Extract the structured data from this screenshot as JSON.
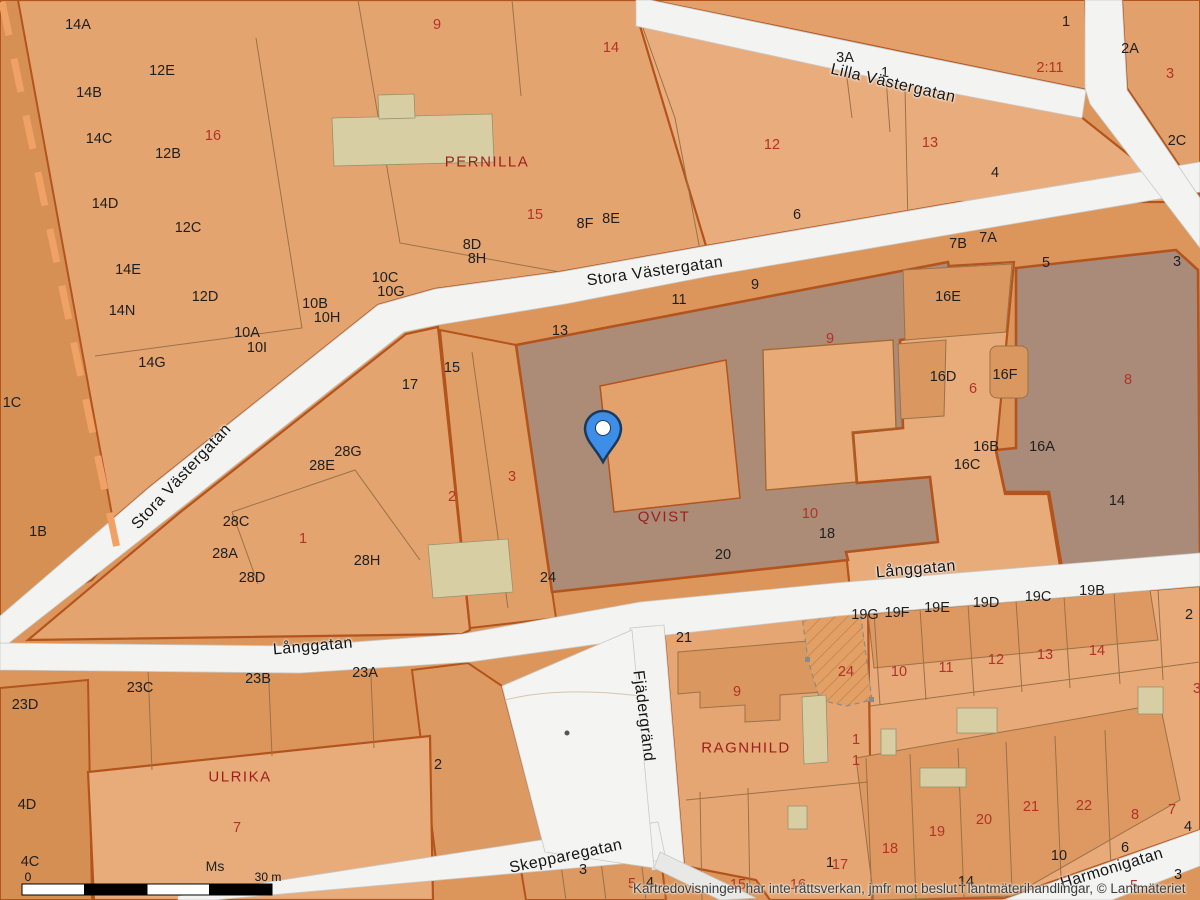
{
  "map": {
    "attribution": "Kartredovisningen har inte rättsverkan, jmfr mot beslut i lantmäterihandlingar, © Lantmäteriet",
    "scale_bar": {
      "start": "0",
      "end": "30 m",
      "sheet": "Ms"
    },
    "pin": {
      "x": 603,
      "y": 462
    },
    "streets": [
      {
        "name": "Stora Västergatan",
        "x": 182,
        "y": 477,
        "rot": -47
      },
      {
        "name": "Stora Västergatan",
        "x": 655,
        "y": 272,
        "rot": -8
      },
      {
        "name": "Lilla Västergatan",
        "x": 893,
        "y": 84,
        "rot": 13
      },
      {
        "name": "Långgatan",
        "x": 916,
        "y": 570,
        "rot": -5
      },
      {
        "name": "Långgatan",
        "x": 313,
        "y": 647,
        "rot": -5
      },
      {
        "name": "Fjädergränd",
        "x": 643,
        "y": 716,
        "rot": 83
      },
      {
        "name": "Skepparegatan",
        "x": 566,
        "y": 857,
        "rot": -12
      },
      {
        "name": "Harmonigatan",
        "x": 1112,
        "y": 869,
        "rot": -17
      }
    ],
    "blocks": [
      {
        "name": "PERNILLA",
        "x": 487,
        "y": 162
      },
      {
        "name": "QVIST",
        "x": 664,
        "y": 517
      },
      {
        "name": "ULRIKA",
        "x": 240,
        "y": 777
      },
      {
        "name": "RAGNHILD",
        "x": 746,
        "y": 748
      }
    ],
    "lot_numbers": [
      {
        "t": "9",
        "x": 437,
        "y": 25
      },
      {
        "t": "14",
        "x": 611,
        "y": 48
      },
      {
        "t": "16",
        "x": 213,
        "y": 136
      },
      {
        "t": "12",
        "x": 772,
        "y": 145
      },
      {
        "t": "13",
        "x": 930,
        "y": 143
      },
      {
        "t": "2:11",
        "x": 1050,
        "y": 68
      },
      {
        "t": "3",
        "x": 1170,
        "y": 74
      },
      {
        "t": "15",
        "x": 535,
        "y": 215
      },
      {
        "t": "9",
        "x": 830,
        "y": 339
      },
      {
        "t": "6",
        "x": 973,
        "y": 389
      },
      {
        "t": "8",
        "x": 1128,
        "y": 380
      },
      {
        "t": "1",
        "x": 303,
        "y": 539
      },
      {
        "t": "2",
        "x": 452,
        "y": 497
      },
      {
        "t": "3",
        "x": 512,
        "y": 477
      },
      {
        "t": "10",
        "x": 810,
        "y": 514
      },
      {
        "t": "24",
        "x": 846,
        "y": 672
      },
      {
        "t": "9",
        "x": 737,
        "y": 692
      },
      {
        "t": "7",
        "x": 237,
        "y": 828
      },
      {
        "t": "1",
        "x": 856,
        "y": 740
      },
      {
        "t": "1",
        "x": 856,
        "y": 761
      },
      {
        "t": "10",
        "x": 899,
        "y": 672
      },
      {
        "t": "11",
        "x": 946,
        "y": 668
      },
      {
        "t": "12",
        "x": 996,
        "y": 660
      },
      {
        "t": "13",
        "x": 1045,
        "y": 655
      },
      {
        "t": "14",
        "x": 1097,
        "y": 651
      },
      {
        "t": "3",
        "x": 1197,
        "y": 689
      },
      {
        "t": "18",
        "x": 890,
        "y": 849
      },
      {
        "t": "19",
        "x": 937,
        "y": 832
      },
      {
        "t": "20",
        "x": 984,
        "y": 820
      },
      {
        "t": "21",
        "x": 1031,
        "y": 807
      },
      {
        "t": "22",
        "x": 1084,
        "y": 806
      },
      {
        "t": "8",
        "x": 1135,
        "y": 815
      },
      {
        "t": "7",
        "x": 1172,
        "y": 810
      },
      {
        "t": "15",
        "x": 738,
        "y": 885
      },
      {
        "t": "16",
        "x": 798,
        "y": 885
      },
      {
        "t": "17",
        "x": 840,
        "y": 865
      },
      {
        "t": "5",
        "x": 632,
        "y": 884
      },
      {
        "t": "5",
        "x": 1134,
        "y": 886
      }
    ],
    "addresses": [
      {
        "t": "14A",
        "x": 78,
        "y": 25
      },
      {
        "t": "12E",
        "x": 162,
        "y": 71
      },
      {
        "t": "14B",
        "x": 89,
        "y": 93
      },
      {
        "t": "14C",
        "x": 99,
        "y": 139
      },
      {
        "t": "12B",
        "x": 168,
        "y": 154
      },
      {
        "t": "14D",
        "x": 105,
        "y": 204
      },
      {
        "t": "12C",
        "x": 188,
        "y": 228
      },
      {
        "t": "14E",
        "x": 128,
        "y": 270
      },
      {
        "t": "12D",
        "x": 205,
        "y": 297
      },
      {
        "t": "14N",
        "x": 122,
        "y": 311
      },
      {
        "t": "10C",
        "x": 385,
        "y": 278
      },
      {
        "t": "10G",
        "x": 391,
        "y": 292
      },
      {
        "t": "10B",
        "x": 315,
        "y": 304
      },
      {
        "t": "10H",
        "x": 327,
        "y": 318
      },
      {
        "t": "10A",
        "x": 247,
        "y": 333
      },
      {
        "t": "10I",
        "x": 257,
        "y": 348
      },
      {
        "t": "14G",
        "x": 152,
        "y": 363
      },
      {
        "t": "1C",
        "x": 12,
        "y": 403
      },
      {
        "t": "1B",
        "x": 38,
        "y": 532
      },
      {
        "t": "8F",
        "x": 585,
        "y": 224
      },
      {
        "t": "8E",
        "x": 611,
        "y": 219
      },
      {
        "t": "8D",
        "x": 472,
        "y": 245
      },
      {
        "t": "8H",
        "x": 477,
        "y": 259
      },
      {
        "t": "3A",
        "x": 845,
        "y": 58
      },
      {
        "t": "1",
        "x": 885,
        "y": 73
      },
      {
        "t": "1",
        "x": 1066,
        "y": 22
      },
      {
        "t": "2A",
        "x": 1130,
        "y": 49
      },
      {
        "t": "2C",
        "x": 1177,
        "y": 141
      },
      {
        "t": "4",
        "x": 995,
        "y": 173
      },
      {
        "t": "6",
        "x": 797,
        "y": 215
      },
      {
        "t": "7B",
        "x": 958,
        "y": 244
      },
      {
        "t": "7A",
        "x": 988,
        "y": 238
      },
      {
        "t": "5",
        "x": 1046,
        "y": 263
      },
      {
        "t": "3",
        "x": 1177,
        "y": 262
      },
      {
        "t": "16E",
        "x": 948,
        "y": 297
      },
      {
        "t": "16D",
        "x": 943,
        "y": 377
      },
      {
        "t": "16F",
        "x": 1005,
        "y": 375
      },
      {
        "t": "16B",
        "x": 986,
        "y": 447
      },
      {
        "t": "16A",
        "x": 1042,
        "y": 447
      },
      {
        "t": "16C",
        "x": 967,
        "y": 465
      },
      {
        "t": "14",
        "x": 1117,
        "y": 501
      },
      {
        "t": "13",
        "x": 560,
        "y": 331
      },
      {
        "t": "11",
        "x": 679,
        "y": 300
      },
      {
        "t": "9",
        "x": 755,
        "y": 285
      },
      {
        "t": "15",
        "x": 452,
        "y": 368
      },
      {
        "t": "17",
        "x": 410,
        "y": 385
      },
      {
        "t": "7",
        "x": 600,
        "y": 452
      },
      {
        "t": "28G",
        "x": 348,
        "y": 452
      },
      {
        "t": "28E",
        "x": 322,
        "y": 466
      },
      {
        "t": "28C",
        "x": 236,
        "y": 522
      },
      {
        "t": "28A",
        "x": 225,
        "y": 554
      },
      {
        "t": "28D",
        "x": 252,
        "y": 578
      },
      {
        "t": "28H",
        "x": 367,
        "y": 561
      },
      {
        "t": "20",
        "x": 723,
        "y": 555
      },
      {
        "t": "18",
        "x": 827,
        "y": 534
      },
      {
        "t": "24",
        "x": 548,
        "y": 578
      },
      {
        "t": "21",
        "x": 684,
        "y": 638
      },
      {
        "t": "19G",
        "x": 865,
        "y": 615
      },
      {
        "t": "19F",
        "x": 897,
        "y": 613
      },
      {
        "t": "19E",
        "x": 937,
        "y": 608
      },
      {
        "t": "19D",
        "x": 986,
        "y": 603
      },
      {
        "t": "19C",
        "x": 1038,
        "y": 597
      },
      {
        "t": "19B",
        "x": 1092,
        "y": 591
      },
      {
        "t": "2",
        "x": 1189,
        "y": 615
      },
      {
        "t": "23D",
        "x": 25,
        "y": 705
      },
      {
        "t": "23C",
        "x": 140,
        "y": 688
      },
      {
        "t": "23B",
        "x": 258,
        "y": 679
      },
      {
        "t": "23A",
        "x": 365,
        "y": 673
      },
      {
        "t": "2",
        "x": 438,
        "y": 765
      },
      {
        "t": "4D",
        "x": 27,
        "y": 805
      },
      {
        "t": "4C",
        "x": 30,
        "y": 862
      },
      {
        "t": "3",
        "x": 583,
        "y": 870
      },
      {
        "t": "4",
        "x": 650,
        "y": 883
      },
      {
        "t": "1",
        "x": 830,
        "y": 863
      },
      {
        "t": "14",
        "x": 966,
        "y": 882
      },
      {
        "t": "10",
        "x": 1059,
        "y": 856
      },
      {
        "t": "6",
        "x": 1125,
        "y": 848
      },
      {
        "t": "4",
        "x": 1188,
        "y": 827
      },
      {
        "t": "3",
        "x": 1178,
        "y": 875
      }
    ],
    "colors": {
      "parcel_light": "#e7a977",
      "parcel_base": "#dc965c",
      "block_gray": "#ac8b77",
      "building_beige": "#d7cfa3",
      "street_white": "#f3f3f1",
      "boundary": "#b4541d",
      "pin_blue": "#3e8ee8",
      "lot_red": "#b23327",
      "block_name_red": "#9e1e1e"
    }
  }
}
